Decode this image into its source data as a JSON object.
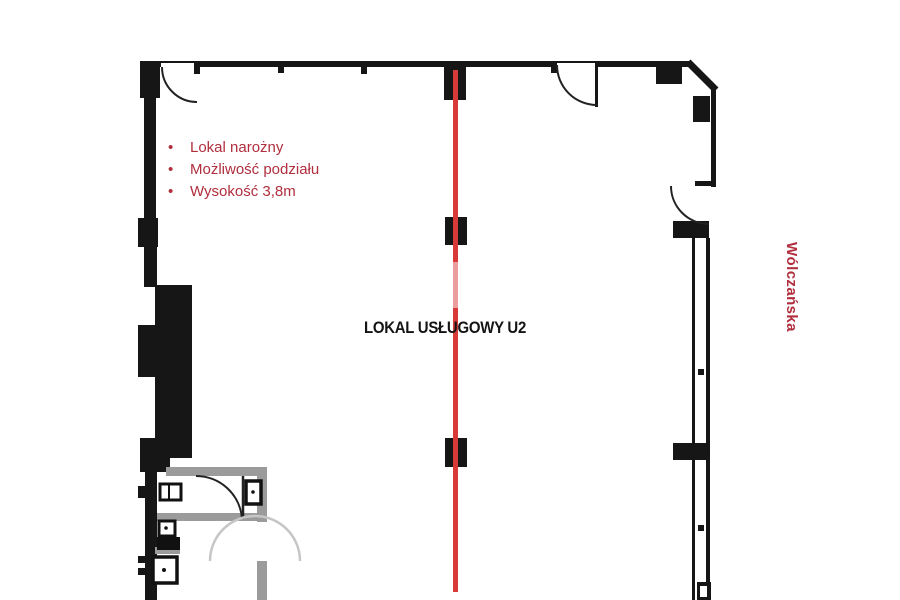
{
  "plan": {
    "features": {
      "bullet_glyph": "•",
      "items": [
        "Lokal narożny",
        "Możliwość podziału",
        "Wysokość 3,8m"
      ]
    },
    "unit_label": "LOKAL USŁUGOWY U2",
    "street_label": "Wólczańska",
    "colors": {
      "wall": "#161616",
      "partition": "#9b9b9b",
      "door_swing_light": "#c6c6c6",
      "division_line": "#d83a3a",
      "annotation_text": "#b02e3d"
    }
  }
}
